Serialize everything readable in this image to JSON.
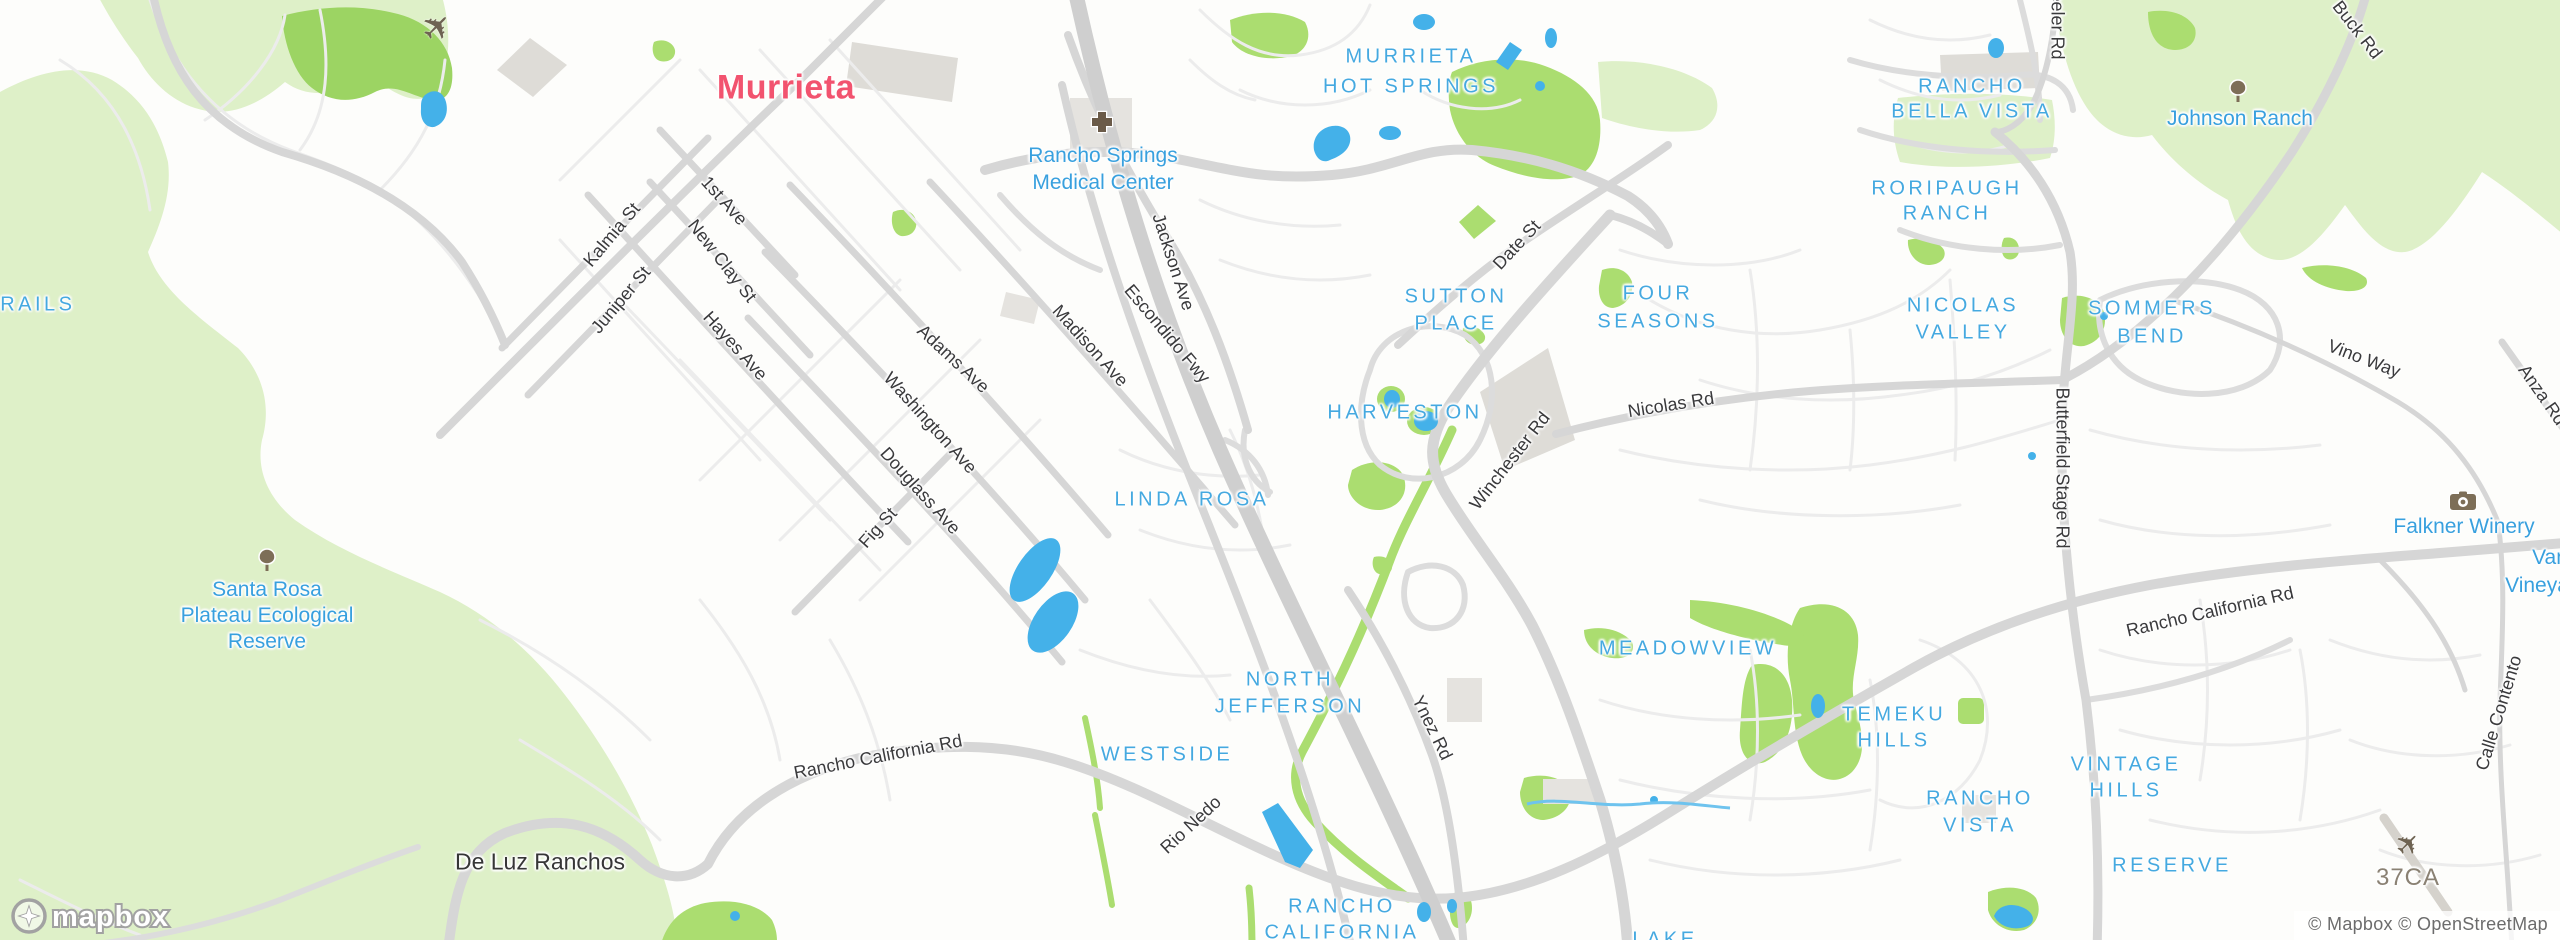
{
  "city": {
    "name": "Murrieta"
  },
  "locality": {
    "name": "De Luz Ranchos"
  },
  "neighborhoods": [
    {
      "lines": [
        "MURRIETA",
        "HOT SPRINGS"
      ]
    },
    {
      "lines": [
        "RANCHO",
        "BELLA VISTA"
      ]
    },
    {
      "lines": [
        "RORIPAUGH",
        "RANCH"
      ]
    },
    {
      "lines": [
        "SUTTON",
        "PLACE"
      ]
    },
    {
      "lines": [
        "FOUR",
        "SEASONS"
      ]
    },
    {
      "lines": [
        "NICOLAS",
        "VALLEY"
      ]
    },
    {
      "lines": [
        "SOMMERS",
        "BEND"
      ]
    },
    {
      "lines": [
        "HARVESTON"
      ]
    },
    {
      "lines": [
        "LINDA ROSA"
      ]
    },
    {
      "lines": [
        "MEADOWVIEW"
      ]
    },
    {
      "lines": [
        "NORTH",
        "JEFFERSON"
      ]
    },
    {
      "lines": [
        "WESTSIDE"
      ]
    },
    {
      "lines": [
        "TEMEKU",
        "HILLS"
      ]
    },
    {
      "lines": [
        "RANCHO",
        "VISTA"
      ]
    },
    {
      "lines": [
        "VINTAGE",
        "HILLS"
      ]
    },
    {
      "lines": [
        "RESERVE"
      ]
    },
    {
      "lines": [
        "RANCHO",
        "CALIFORNIA"
      ]
    },
    {
      "lines": [
        "LAKE"
      ]
    },
    {
      "lines": [
        "TRAILS"
      ]
    }
  ],
  "streets": [
    {
      "name": "Kalmia St"
    },
    {
      "name": "Juniper St"
    },
    {
      "name": "1st Ave"
    },
    {
      "name": "New Clay St"
    },
    {
      "name": "Hayes Ave"
    },
    {
      "name": "Adams Ave"
    },
    {
      "name": "Madison Ave"
    },
    {
      "name": "Washington Ave"
    },
    {
      "name": "Douglass Ave"
    },
    {
      "name": "Fig St"
    },
    {
      "name": "Jackson Ave"
    },
    {
      "name": "Escondido Fwy"
    },
    {
      "name": "Date St"
    },
    {
      "name": "Winchester Rd"
    },
    {
      "name": "Nicolas Rd"
    },
    {
      "name": "Ynez Rd"
    },
    {
      "name": "Rio Nedo"
    },
    {
      "name": "Rancho California Rd"
    },
    {
      "name": "Rancho California Rd"
    },
    {
      "name": "Butterfield Stage Rd"
    },
    {
      "name": "Vino Way"
    },
    {
      "name": "Anza Rd"
    },
    {
      "name": "Calle Contento"
    },
    {
      "name": "Buck Rd"
    },
    {
      "name": "Wheeler Rd"
    }
  ],
  "pois": {
    "medical": {
      "lines": [
        "Rancho Springs",
        "Medical Center"
      ],
      "icon": "hospital-icon"
    },
    "reserve": {
      "lines": [
        "Santa Rosa",
        "Plateau Ecological",
        "Reserve"
      ],
      "icon": "tree-icon"
    },
    "johnson": {
      "lines": [
        "Johnson Ranch"
      ],
      "icon": "tree-icon"
    },
    "falkner": {
      "lines": [
        "Falkner Winery"
      ],
      "icon": "camera-icon"
    },
    "vineyard": {
      "lines": [
        "Van",
        "Vineya"
      ]
    },
    "airfield": {
      "lines": [
        "37CA"
      ],
      "icon": "airplane-icon"
    }
  },
  "logo": {
    "text": "mapbox"
  },
  "attribution": {
    "text": "© Mapbox © OpenStreetMap"
  },
  "colors": {
    "water": "#44b1e9",
    "park_green": "#abdd70",
    "reserve_green": "#def0c8",
    "road_gray": "#d6d6d6",
    "city_label": "#f2536f",
    "neighborhood_label": "#45a9e0",
    "poi_label": "#38a0de",
    "street_label": "#3a3a3c"
  }
}
